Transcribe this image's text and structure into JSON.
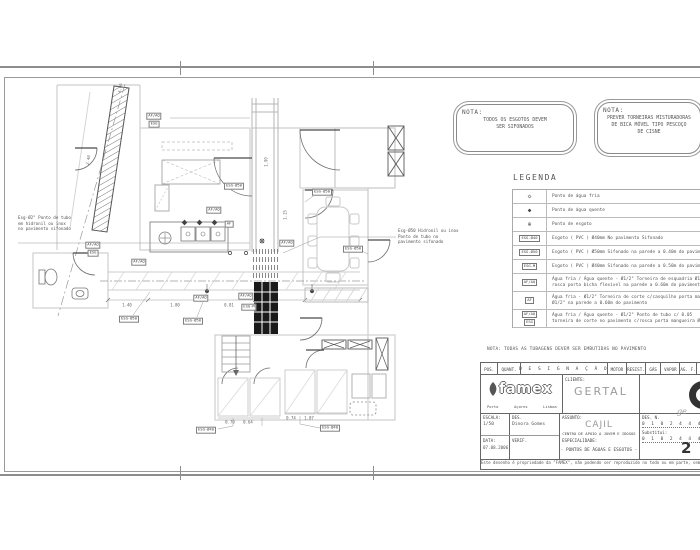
{
  "notes": {
    "note1": {
      "title": "NOTA:",
      "lines": [
        "TODOS OS ESGOTOS DEVEM",
        "SER SIFONADOS"
      ]
    },
    "note2": {
      "title": "NOTA:",
      "lines": [
        "PREVER TORNEIRAS MISTURADORAS",
        "DE BICA MÓVEL TIPO PESCOÇO",
        "DE CISNE"
      ]
    },
    "pavimento": "NOTA: TODAS AS TUBAGENS DEVEM SER EMBUTIDAS NO PAVIMENTO"
  },
  "legend": {
    "title": "LEGENDA",
    "rows": [
      {
        "symbol": "◇",
        "text": "Ponto de água fria"
      },
      {
        "symbol": "◆",
        "text": "Ponto de água quente"
      },
      {
        "symbol": "⊕",
        "text": "Ponto de esgoto"
      },
      {
        "tag": "ESG-Ø40",
        "text": "Esgoto ( PVC ) Ø40mm No pavimento Sifonado"
      },
      {
        "tag": "ESG-Ø50",
        "text": "Esgoto ( PVC ) Ø50mm Sifonado na parede a 0.40m do pavimento"
      },
      {
        "tag": "ESG-M",
        "text": "Esgoto ( PVC ) Ø40mm Sifonado na parede a 0.50m do pavimento"
      },
      {
        "tag": "AF/AQ",
        "text": "Água fria / Água quente - Ø1/2\" Torneira de esquadria Ø1/2\" c/",
        "text2": "rosca porta bicha flexível na parede a 0.60m do pavimento"
      },
      {
        "tag": "AF",
        "text": "Água fria - Ø1/2\" Torneira de corte c/casquilho porta mangueira",
        "text2": "Ø1/2\" na parede a 0.60m do pavimento"
      },
      {
        "tag": "AF/AQ",
        "tag2": "ESG",
        "text": "Água fria / Água quente - Ø1/2\" Ponto de tubo c/ 0.05",
        "text2": "torneira de corte no pavimento c/rosca porta mangueira Ø1/2\""
      }
    ]
  },
  "plan": {
    "tags": [
      {
        "label": "AF/AQ"
      },
      {
        "label": "ESG"
      },
      {
        "label": "ESG-Ø50"
      },
      {
        "label": "ESG-Ø50"
      },
      {
        "label": "AF/AQ"
      },
      {
        "label": "AF"
      },
      {
        "label": "AF/AQ"
      },
      {
        "label": "AF/AQ"
      },
      {
        "label": "ESG-Ø50"
      },
      {
        "label": "ESG-Ø50"
      },
      {
        "label": "AF/AQ"
      },
      {
        "label": "ESG-M"
      },
      {
        "label": "ESG-Ø40"
      },
      {
        "label": "ESG-Ø40"
      },
      {
        "label": "AF/AQ"
      },
      {
        "label": "ESG-Ø50"
      },
      {
        "label": "AF/AQ"
      },
      {
        "label": "ESG"
      }
    ],
    "dims": [
      {
        "value": "4.06"
      },
      {
        "value": "2.40"
      },
      {
        "value": "1.40"
      },
      {
        "value": "1.80"
      },
      {
        "value": "0.81"
      },
      {
        "value": "0.70"
      },
      {
        "value": "0.64"
      },
      {
        "value": "0.74"
      },
      {
        "value": "1.07"
      },
      {
        "value": "1.90"
      },
      {
        "value": "1.15"
      }
    ],
    "callouts": [
      {
        "text": "Esg-Ø2\" Ponto de tubo\nem hidronil ou inox\nno pavimento sifonado"
      },
      {
        "text": "Esg-Ø50 Hidronil ou inox\nPonto de tubo no\npavimento sifonado"
      }
    ]
  },
  "titleblock": {
    "header": {
      "pos": "POS.",
      "quant": "QUANT.",
      "designacao": "D E S I G N A Ç Ã O",
      "motor": "MOTOR",
      "resist": "RESIST.",
      "gas": "GÁS",
      "vapor": "VAPOR",
      "agf": "AG. F.",
      "agq": "AG"
    },
    "company": {
      "logo": "famex",
      "cities": [
        "Porto",
        "Açores",
        "Lisboa"
      ]
    },
    "cliente_label": "CLIENTE:",
    "cliente": "GERTAL",
    "escala_label": "ESCALA:",
    "escala": "1/50",
    "data_label": "DATA:",
    "data": "07.08.2006",
    "des_label": "DES.",
    "des": "Dinora Gomes",
    "verif_label": "VERIF.",
    "assunto_label": "ASSUNTO:",
    "assunto": "CAJIL",
    "assunto_sub": "CENTRO DE APOIO A JOVEM E IDOSOS",
    "especialidade_label": "ESPECIALIDADE:",
    "especialidade": "- PONTOS DE ÁGUAS E ESGOTOS -",
    "desn_label": "DES. N.",
    "desn": "0 1 0 2 4 4 4 4",
    "substitui_label": "Substitui:",
    "substitui": "0 1 0 2 4 4 4 4",
    "sheet_number": "2",
    "corner_mark": "ge",
    "copyright": "Este desenho é propriedade da \"FAMEX\", não podendo ser reproduzido no todo ou em parte, sem sua autorização"
  },
  "colors": {
    "paper": "#ffffff",
    "frame": "#8d8d8d",
    "wall_light": "#c9c9c9",
    "wall_dark": "#555555",
    "grate_fill": "#1a1a1a",
    "text": "#555555"
  }
}
